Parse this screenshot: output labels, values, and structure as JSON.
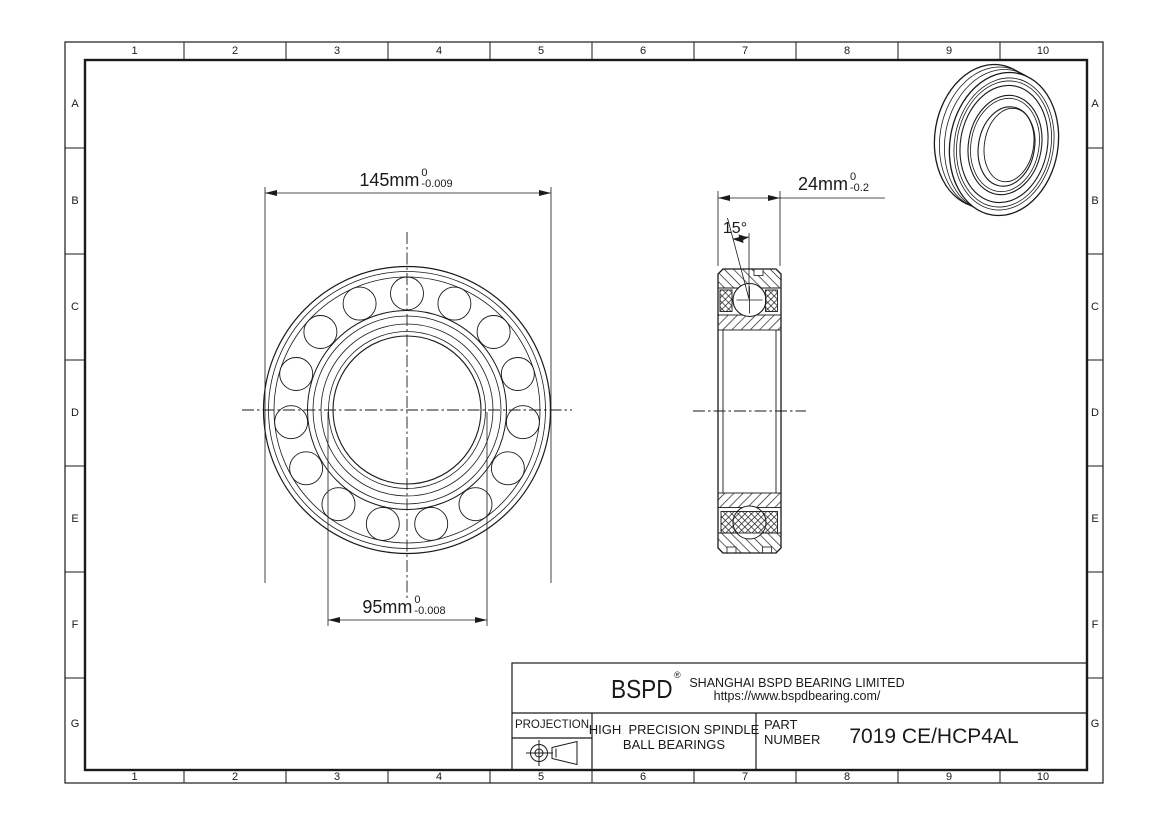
{
  "sheet": {
    "background_color": "#ffffff",
    "line_color": "#1a1a1a"
  },
  "grid": {
    "columns": [
      "1",
      "2",
      "3",
      "4",
      "5",
      "6",
      "7",
      "8",
      "9",
      "10"
    ],
    "rows": [
      "A",
      "B",
      "C",
      "D",
      "E",
      "F",
      "G"
    ]
  },
  "views": {
    "front_view": "bearing front view",
    "section_view": "bearing cross-section view",
    "iso_view": "bearing 3d line rendering"
  },
  "dimensions": {
    "outer_diameter": {
      "value": "145mm",
      "tolerance_upper": "0",
      "tolerance_lower": "-0.009"
    },
    "bore_diameter": {
      "value": "95mm",
      "tolerance_upper": "0",
      "tolerance_lower": "-0.008"
    },
    "width": {
      "value": "24mm",
      "tolerance_upper": "0",
      "tolerance_lower": "-0.2"
    },
    "contact_angle": {
      "value": "15°"
    }
  },
  "title_block": {
    "brand": "BSPD",
    "registered_mark": "®",
    "company": "SHANGHAI BSPD BEARING LIMITED",
    "website": "https://www.bspdbearing.com/",
    "projection_label": "PROJECTION",
    "projection_icon": "third-angle-projection-symbol",
    "product_line1": "HIGH  PRECISION SPINDLE",
    "product_line2": "BALL BEARINGS",
    "part_label_line1": "PART",
    "part_label_line2": "NUMBER",
    "part_number": "7019 CE/HCP4AL"
  }
}
